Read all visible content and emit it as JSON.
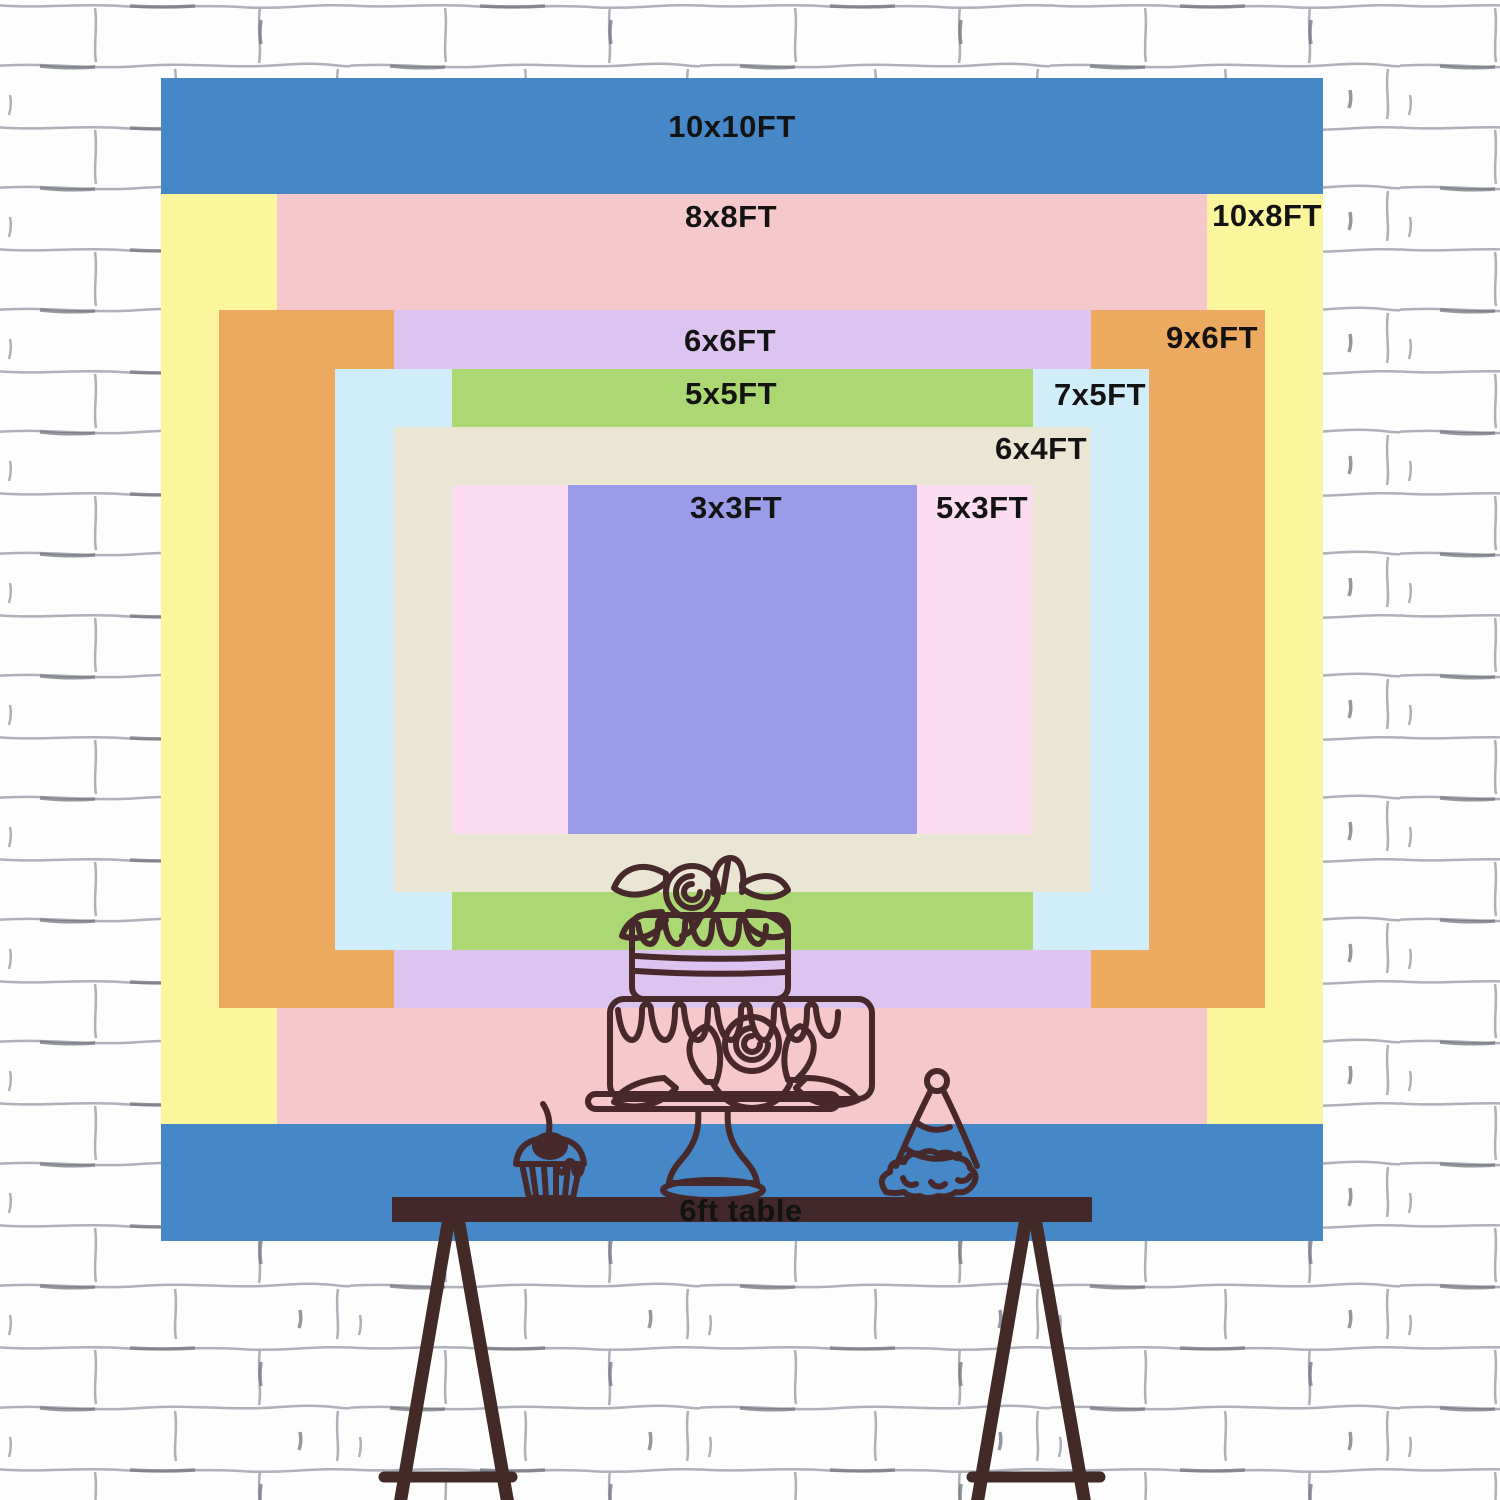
{
  "wall": {
    "background": "#fdfdfd",
    "line_color": "#a6a8b3",
    "accent_line_color": "#73757f"
  },
  "backdrop": {
    "text_color": "#131313",
    "sizes": [
      {
        "id": "10x10",
        "label": "10x10FT",
        "color": "#4687c7"
      },
      {
        "id": "10x8",
        "label": "10x8FT",
        "color": "#fbf59d"
      },
      {
        "id": "8x8",
        "label": "8x8FT",
        "color": "#f5c9cb"
      },
      {
        "id": "9x6",
        "label": "9x6FT",
        "color": "#ebaa5f"
      },
      {
        "id": "6x6",
        "label": "6x6FT",
        "color": "#ddc3f0"
      },
      {
        "id": "7x5",
        "label": "7x5FT",
        "color": "#cfeef9"
      },
      {
        "id": "5x5",
        "label": "5x5FT",
        "color": "#acd873"
      },
      {
        "id": "6x4",
        "label": "6x4FT",
        "color": "#ebe5d4"
      },
      {
        "id": "5x3",
        "label": "5x3FT",
        "color": "#fcdcf1"
      },
      {
        "id": "3x3",
        "label": "3x3FT",
        "color": "#9a9ce9"
      }
    ]
  },
  "table": {
    "label": "6ft table",
    "top_color": "#42282a",
    "leg_color": "#432a27"
  },
  "illustration": {
    "stroke_color": "#47282b",
    "items": [
      "two-tier-cake-on-stand",
      "cupcake-with-cherry",
      "party-hat"
    ]
  }
}
